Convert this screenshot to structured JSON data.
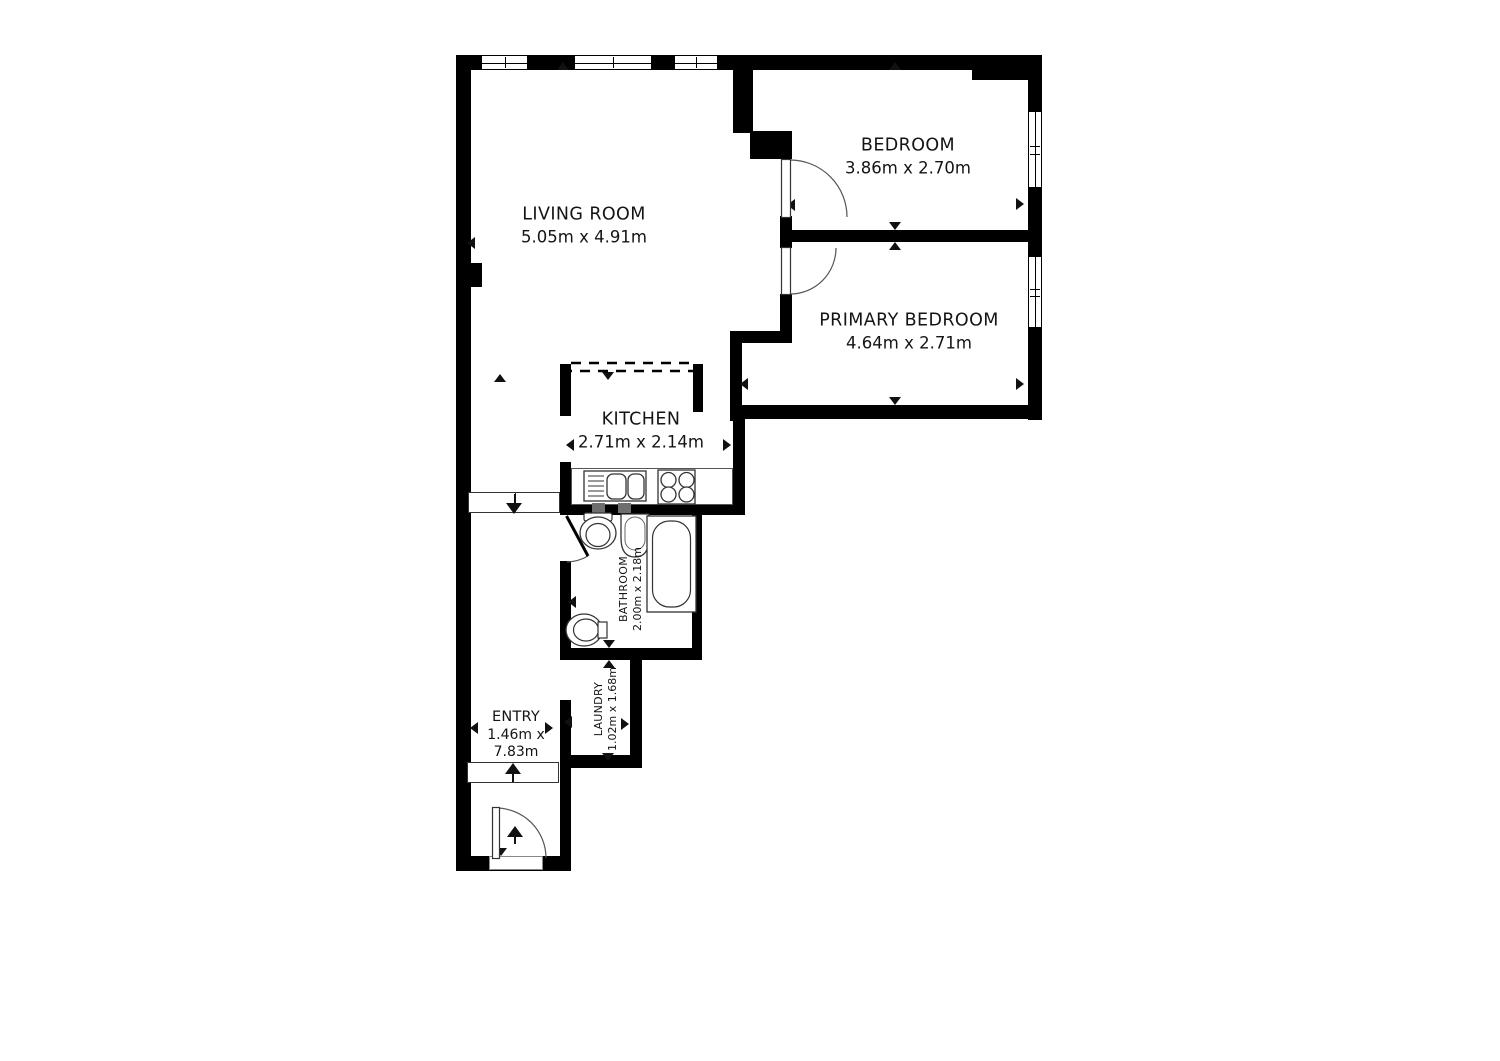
{
  "floorplan": {
    "rooms": [
      {
        "name": "LIVING ROOM",
        "dims": "5.05m x 4.91m"
      },
      {
        "name": "BEDROOM",
        "dims": "3.86m x 2.70m"
      },
      {
        "name": "PRIMARY BEDROOM",
        "dims": "4.64m x 2.71m"
      },
      {
        "name": "KITCHEN",
        "dims": "2.71m x 2.14m"
      },
      {
        "name": "BATHROOM",
        "dims": "2.00m x 2.18m"
      },
      {
        "name": "LAUNDRY",
        "dims": "1.02m x 1.68m"
      },
      {
        "name": "ENTRY",
        "dims_line1": "1.46m x",
        "dims_line2": "7.83m"
      }
    ],
    "colors": {
      "wall": "#000000",
      "background": "#ffffff",
      "label_text": "#141414",
      "fixture_outline": "#333333"
    }
  }
}
